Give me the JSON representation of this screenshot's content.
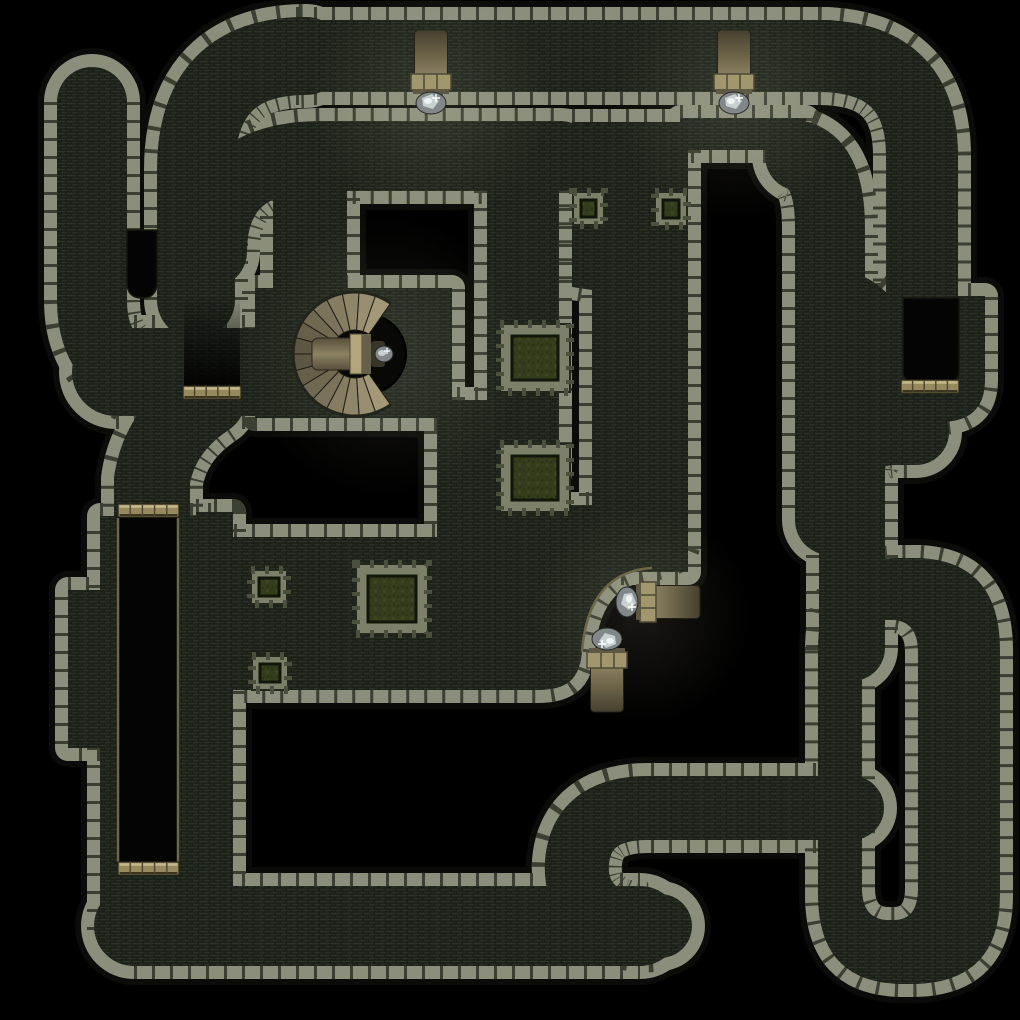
{
  "map": {
    "kind": "dungeon-battlemap",
    "canvas": {
      "width": 1020,
      "height": 1020,
      "background": "#000000"
    },
    "palette": {
      "background": "#000000",
      "wall_stone": "#8a8e7b",
      "wall_seam": "#3b3f31",
      "wall_rim": "#0b0c09",
      "floor_base": "#242a1f",
      "floor_brick_a": "#2a3126",
      "floor_brick_b": "#222821",
      "floor_line": "#171c15",
      "door_base": "#96895e",
      "door_light": "#c3b88b",
      "door_dark": "#4b432c",
      "trim": "#6e6749",
      "moss": "#333d1c",
      "moss_dark": "#11160a",
      "planter_stone": "#7c8069",
      "torch_band": "#a2966c",
      "torch_band_dark": "#4e4836",
      "crystal_base": "#82888a",
      "crystal_light": "#c9d0d2",
      "stair_light": "#a39878",
      "stair_dark": "#57513f",
      "pit_fill": "#040404"
    },
    "corridors": [
      {
        "name": "dead-end-stub-north-west",
        "d": "M 92 102 L 92 300 Q 92 366 152 382",
        "w": 70
      },
      {
        "name": "west-descender",
        "d": "M 196 300 L 196 170 Q 196 56 306 56",
        "w": 78
      },
      {
        "name": "north-outer-corridor",
        "d": "M 296 56 L 828 56",
        "w": 72
      },
      {
        "name": "north-east-descender",
        "d": "M 818 56 Q 922 56 922 156 L 922 298",
        "w": 72
      },
      {
        "name": "north-inner-corridor",
        "d": "M 212 252 Q 212 156 322 156 L 560 156",
        "w": 70
      },
      {
        "name": "mid-east-descender",
        "d": "M 800 156 Q 830 166 830 228 L 830 520",
        "w": 70
      },
      {
        "name": "mid-east-link",
        "d": "M 845 300 Q 890 310 893 414",
        "w": 56
      },
      {
        "name": "garden-corridor",
        "d": "M 523 190 L 523 470",
        "w": 72
      },
      {
        "name": "stair-room-drop",
        "d": "M 310 180 L 310 300",
        "w": 74
      },
      {
        "name": "west-junction",
        "d": "M 116 372 L 254 372",
        "w": 88
      },
      {
        "name": "west-junction-drop",
        "d": "M 208 398 Q 160 430 152 480 L 152 514",
        "w": 76
      },
      {
        "name": "south-corridor",
        "d": "M 134 926 L 640 926",
        "w": 80
      },
      {
        "name": "south-east-uturn",
        "d": "M 852 808 L 648 808 Q 582 808 577 862 Q 574 905 615 922 Q 640 930 660 926",
        "w": 64
      },
      {
        "name": "ring-limb",
        "d": "M 852 648 L 852 472 Q 852 432 896 432 L 916 432",
        "w": 66
      }
    ],
    "rooms": [
      {
        "name": "stair-room",
        "d": "M 255 288 L 452 288 L 452 418 L 255 418 Z"
      },
      {
        "name": "east-hall",
        "d": "M 572 122 L 688 122 L 688 572 L 592 572 L 592 290 L 572 287 Z"
      },
      {
        "name": "inner-strip-east",
        "d": "M 680 118 L 806 118 L 806 150 L 680 150 Z"
      },
      {
        "name": "lower-hall",
        "d": "M 180 537 L 437 537 L 437 400 L 500 400 L 500 505 L 688 505 L 688 540 Q 688 564 652 568 Q 588 572 582 652 Q 580 676 566 684 Q 556 690 538 690 L 196 690 Q 180 690 180 674 Z"
      },
      {
        "name": "west-room",
        "d": "M 100 516 L 216 516 L 216 940 L 100 940 Z"
      },
      {
        "name": "west-bump",
        "d": "M 68 590 L 104 590 L 104 748 L 68 748 Z"
      },
      {
        "name": "west-strip",
        "d": "M 196 512 L 233 512 L 233 892 L 196 892 Z"
      },
      {
        "name": "north-bulb",
        "d": "M 878 296 L 985 296 L 985 380 Q 985 422 940 422 L 918 422 Q 878 422 878 382 Z"
      },
      {
        "name": "ring",
        "d": "M 818 650 Q 818 560 895 558 L 920 558 Q 1000 562 1000 650 L 1000 895 Q 1000 982 915 984 L 900 984 Q 818 982 818 895 Z M 862 650 Q 862 620 886 620 L 894 620 Q 918 622 918 652 L 918 888 Q 918 920 894 920 L 886 920 Q 862 918 862 888 Z",
        "evenodd": true
      }
    ],
    "voids": [
      {
        "name": "wall-notch",
        "d": "M 127 230 L 157 230 L 157 282 Q 157 298 142 298 Q 127 298 127 282 Z"
      },
      {
        "name": "bulb-closet",
        "d": "M 903 298 L 959 298 L 959 372 Q 959 381 950 381 L 912 381 Q 903 381 903 372 Z"
      },
      {
        "name": "pit",
        "d": "M 117 517 L 179 517 L 179 863 L 117 863 Z"
      }
    ],
    "shadows": [
      {
        "name": "door-approach-shadow",
        "x": 184,
        "y": 296,
        "w": 56,
        "h": 90
      }
    ],
    "trim_lines": [
      {
        "name": "pit-edge-west",
        "d": "M 118 518 L 118 862"
      },
      {
        "name": "pit-edge-east",
        "d": "M 178 518 L 178 862"
      },
      {
        "name": "alcove-rail",
        "d": "M 652 568 Q 588 572 582 652"
      }
    ],
    "doors": [
      {
        "name": "door-west-junction",
        "x": 183,
        "y": 386,
        "w": 58,
        "h": 13
      },
      {
        "name": "door-pit-north",
        "x": 118,
        "y": 504,
        "w": 61,
        "h": 13
      },
      {
        "name": "door-pit-south",
        "x": 118,
        "y": 862,
        "w": 61,
        "h": 13
      },
      {
        "name": "door-bulb-closet",
        "x": 901,
        "y": 380,
        "w": 58,
        "h": 13
      }
    ],
    "planters": [
      {
        "name": "moss-planter-north",
        "x": 500,
        "y": 324,
        "w": 70,
        "h": 68
      },
      {
        "name": "moss-planter-middle",
        "x": 500,
        "y": 444,
        "w": 70,
        "h": 68
      },
      {
        "name": "moss-planter-south",
        "x": 356,
        "y": 564,
        "w": 72,
        "h": 70
      }
    ],
    "pillars": [
      {
        "name": "moss-pillar-east-1",
        "x": 573,
        "y": 192,
        "w": 31,
        "h": 33
      },
      {
        "name": "moss-pillar-east-2",
        "x": 655,
        "y": 192,
        "w": 32,
        "h": 34
      },
      {
        "name": "moss-pillar-west-1",
        "x": 251,
        "y": 570,
        "w": 36,
        "h": 34
      },
      {
        "name": "moss-pillar-west-2",
        "x": 252,
        "y": 656,
        "w": 36,
        "h": 34
      }
    ],
    "torches": [
      {
        "name": "wall-torch-north-west",
        "x": 431,
        "y": 30,
        "rotate": 0
      },
      {
        "name": "wall-torch-north-east",
        "x": 734,
        "y": 30,
        "rotate": 0
      },
      {
        "name": "alcove-torch-east",
        "x": 700,
        "y": 602,
        "rotate": 90
      },
      {
        "name": "alcove-torch-south",
        "x": 607,
        "y": 712,
        "rotate": 180
      }
    ],
    "glows": [
      {
        "x": 431,
        "y": 100,
        "r": 120
      },
      {
        "x": 734,
        "y": 100,
        "r": 120
      },
      {
        "x": 385,
        "y": 356,
        "r": 140
      },
      {
        "x": 640,
        "y": 615,
        "r": 110
      }
    ],
    "stairs": {
      "name": "spiral-staircase",
      "cx": 355,
      "cy": 354,
      "r_outer": 62,
      "r_inner": 24,
      "start_deg": 55,
      "end_deg": 305,
      "steps": 16,
      "well_cx": 366,
      "well_cy": 354,
      "well_r": 40
    }
  }
}
